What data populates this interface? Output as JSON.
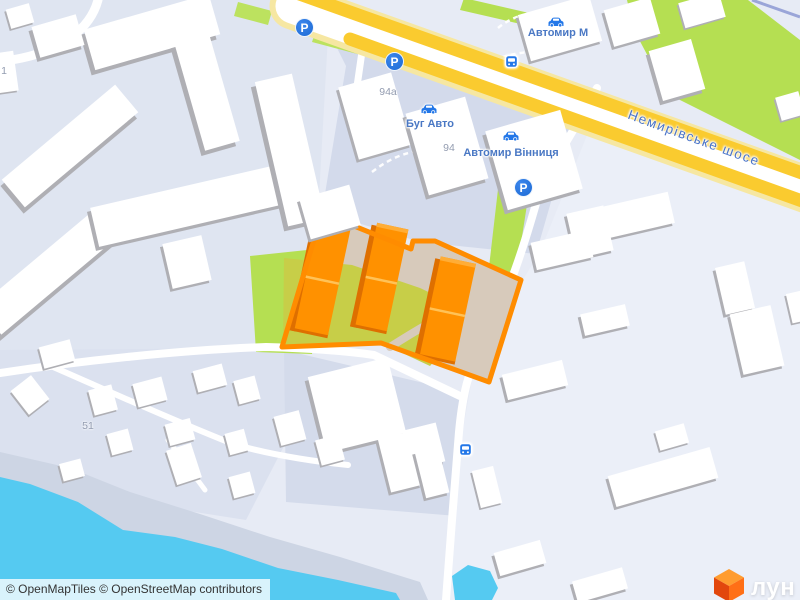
{
  "attribution": "© OpenMapTiles © OpenStreetMap contributors",
  "road_label": "Немирівське шосе",
  "poi": {
    "avtomyr_m": "Автомир М",
    "bug_avto": "Буг Авто",
    "avtomyr_vinnytsia": "Автомир Вінниця"
  },
  "house_numbers": {
    "h94a": "94а",
    "h94": "94",
    "h51": "51",
    "h1": "1"
  },
  "icons": {
    "parking_letter": "P",
    "parking": "parking-icon",
    "bus_stop": "bus-stop-icon",
    "car_dealership": "car-dealership-icon"
  },
  "logo": {
    "text": "лун"
  },
  "colors": {
    "water": "#55CAF1",
    "park_green": "#B5DF52",
    "highway_yellow": "#FACB2F",
    "site_border": "#FF8C00",
    "site_building": "#FF9100",
    "site_fill_tan": "#D7CABB",
    "site_fill_green": "#C7CE48",
    "icon_blue": "#2377E8",
    "label_blue": "#4A78C4"
  }
}
